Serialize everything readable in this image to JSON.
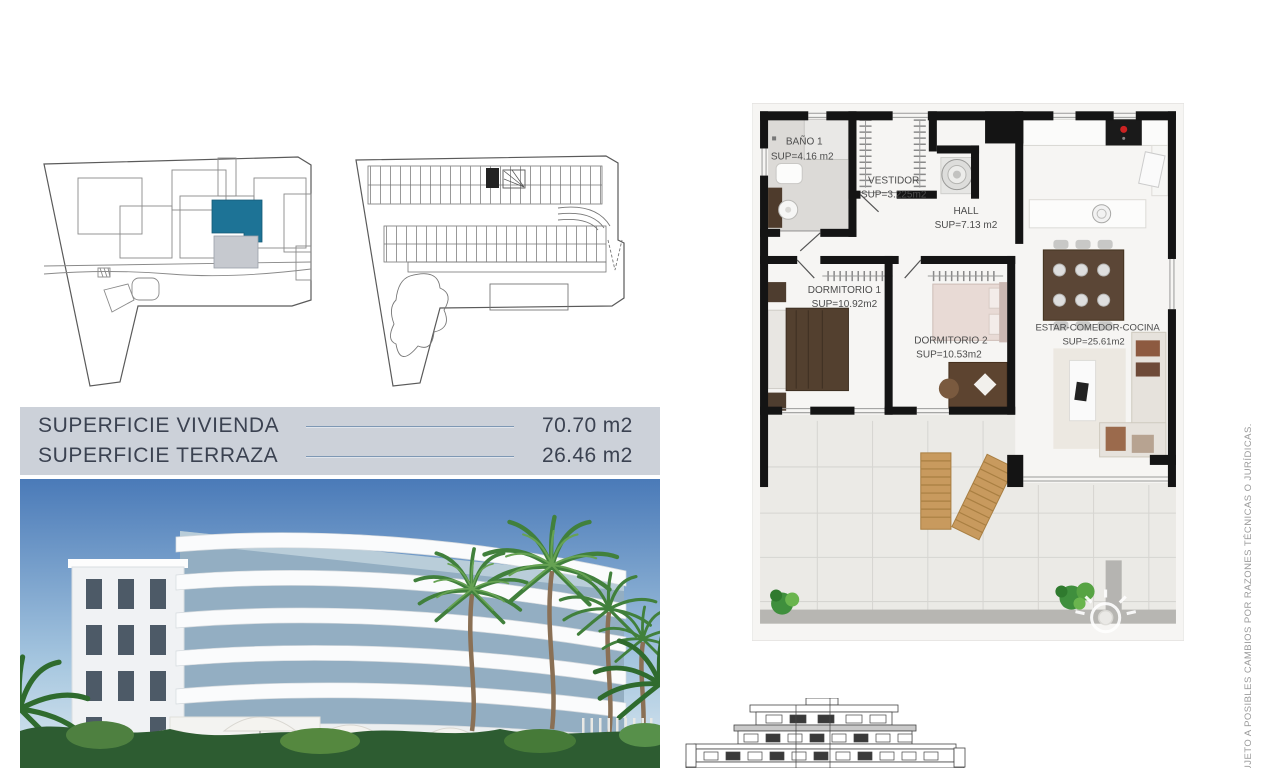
{
  "colors": {
    "highlight_unit": "#1d7396",
    "highlight_terrace_gray": "#c6c9cf",
    "table_background": "#ccd1d9",
    "table_rule": "#7e98b4",
    "table_text": "#3b4251",
    "plan_wall": "#141414",
    "terrace_tile": "#ebeae6",
    "sky": "#4a7ab8",
    "vegetation_green": "#2d5c31",
    "lounger_wood": "#c89a5e"
  },
  "surface_table": {
    "rows": [
      {
        "label": "SUPERFICIE VIVIENDA",
        "value": "70.70 m2"
      },
      {
        "label": "SUPERFICIE TERRAZA",
        "value": "26.46 m2"
      }
    ]
  },
  "floor_plan": {
    "rooms": [
      {
        "name": "BAÑO 1",
        "area": "SUP=4.16 m2"
      },
      {
        "name": "VESTIDOR",
        "area": "SUP=3.225m2"
      },
      {
        "name": "HALL",
        "area": "SUP=7.13  m2"
      },
      {
        "name": "DORMITORIO 1",
        "area": "SUP=10.92m2"
      },
      {
        "name": "DORMITORIO 2",
        "area": "SUP=10.53m2"
      },
      {
        "name": "ESTAR-COMEDOR-COCINA",
        "area": "SUP=25.61m2"
      }
    ]
  },
  "disclaimer": {
    "text": "UJETO A POSIBLES CAMBIOS POR RAZONES TÉCNICAS O JURÍDICAS."
  }
}
